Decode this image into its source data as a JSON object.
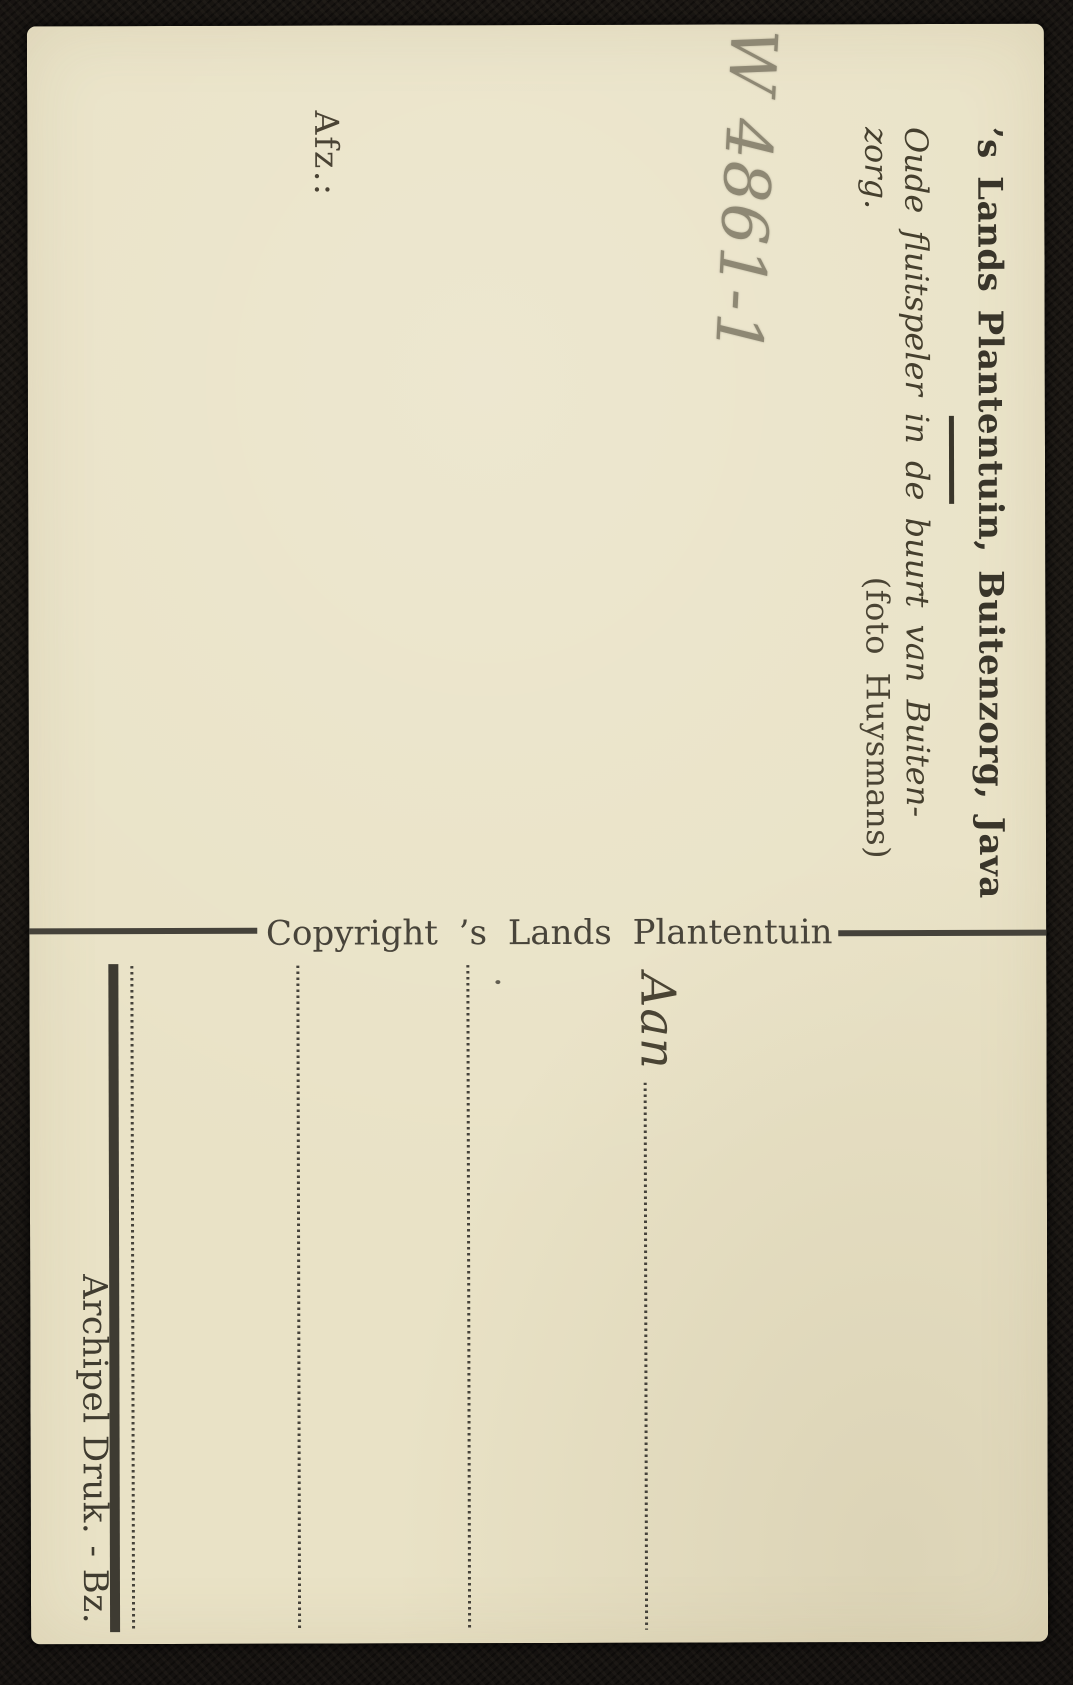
{
  "postcard": {
    "handwritten_note": "W 4861-1",
    "title": "’s Lands Plantentuin, Buitenzorg, Java",
    "caption_line1": "Oude fluitspeler in de buurt van Buiten-",
    "caption_line2": "zorg.",
    "caption_credit": "(foto Huysmans)",
    "sender_label": "Afz.:",
    "copyright_line": "Copyright ’s Lands Plantentuin",
    "address_label": "Aan",
    "printer_imprint": "Archipel Druk. - Bz.",
    "colors": {
      "card": "#e9e2c6",
      "ink": "#3e3b32",
      "pencil": "#8e8874",
      "background": "#171411"
    }
  }
}
